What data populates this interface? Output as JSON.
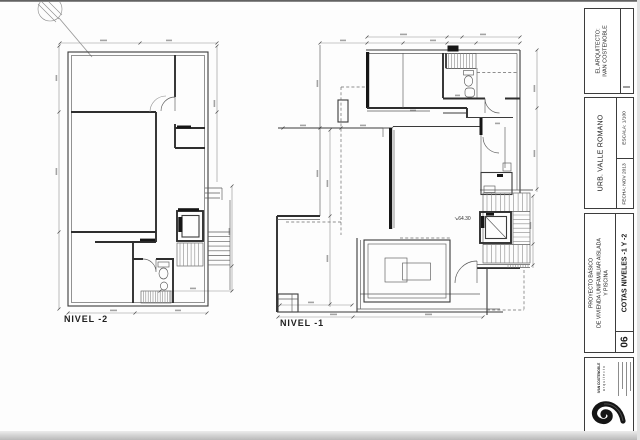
{
  "plans": {
    "nivel_minus_2": {
      "label": "NIVEL -2"
    },
    "nivel_minus_1": {
      "label": "NIVEL -1",
      "marker_arrow": "↘",
      "marker_value": "64.30"
    }
  },
  "title_block": {
    "architect_heading": "EL ARQUITECTO:",
    "architect_name": "IVAN COSTENOBLE",
    "urbanization": "URB. VALLE ROMANO",
    "scale": "ESCALA: 1/100",
    "date": "FECHA: NOV 2013",
    "project_line1": "PROYECTO BÁSICO",
    "project_line2": "DE VIVIENDA UNIFAMILIAR AISLADA",
    "project_line3": "Y PISCINA",
    "sheet_number": "06",
    "sheet_title": "COTAS NIVELES -1 Y -2",
    "logo_name": "IVAN COSTENOBLE",
    "logo_subtitle": "arquitecto"
  },
  "colors": {
    "line": "#3a3a3a",
    "dim": "#8f8f8f",
    "paper": "#fdfdfd",
    "ink": "#161616"
  }
}
